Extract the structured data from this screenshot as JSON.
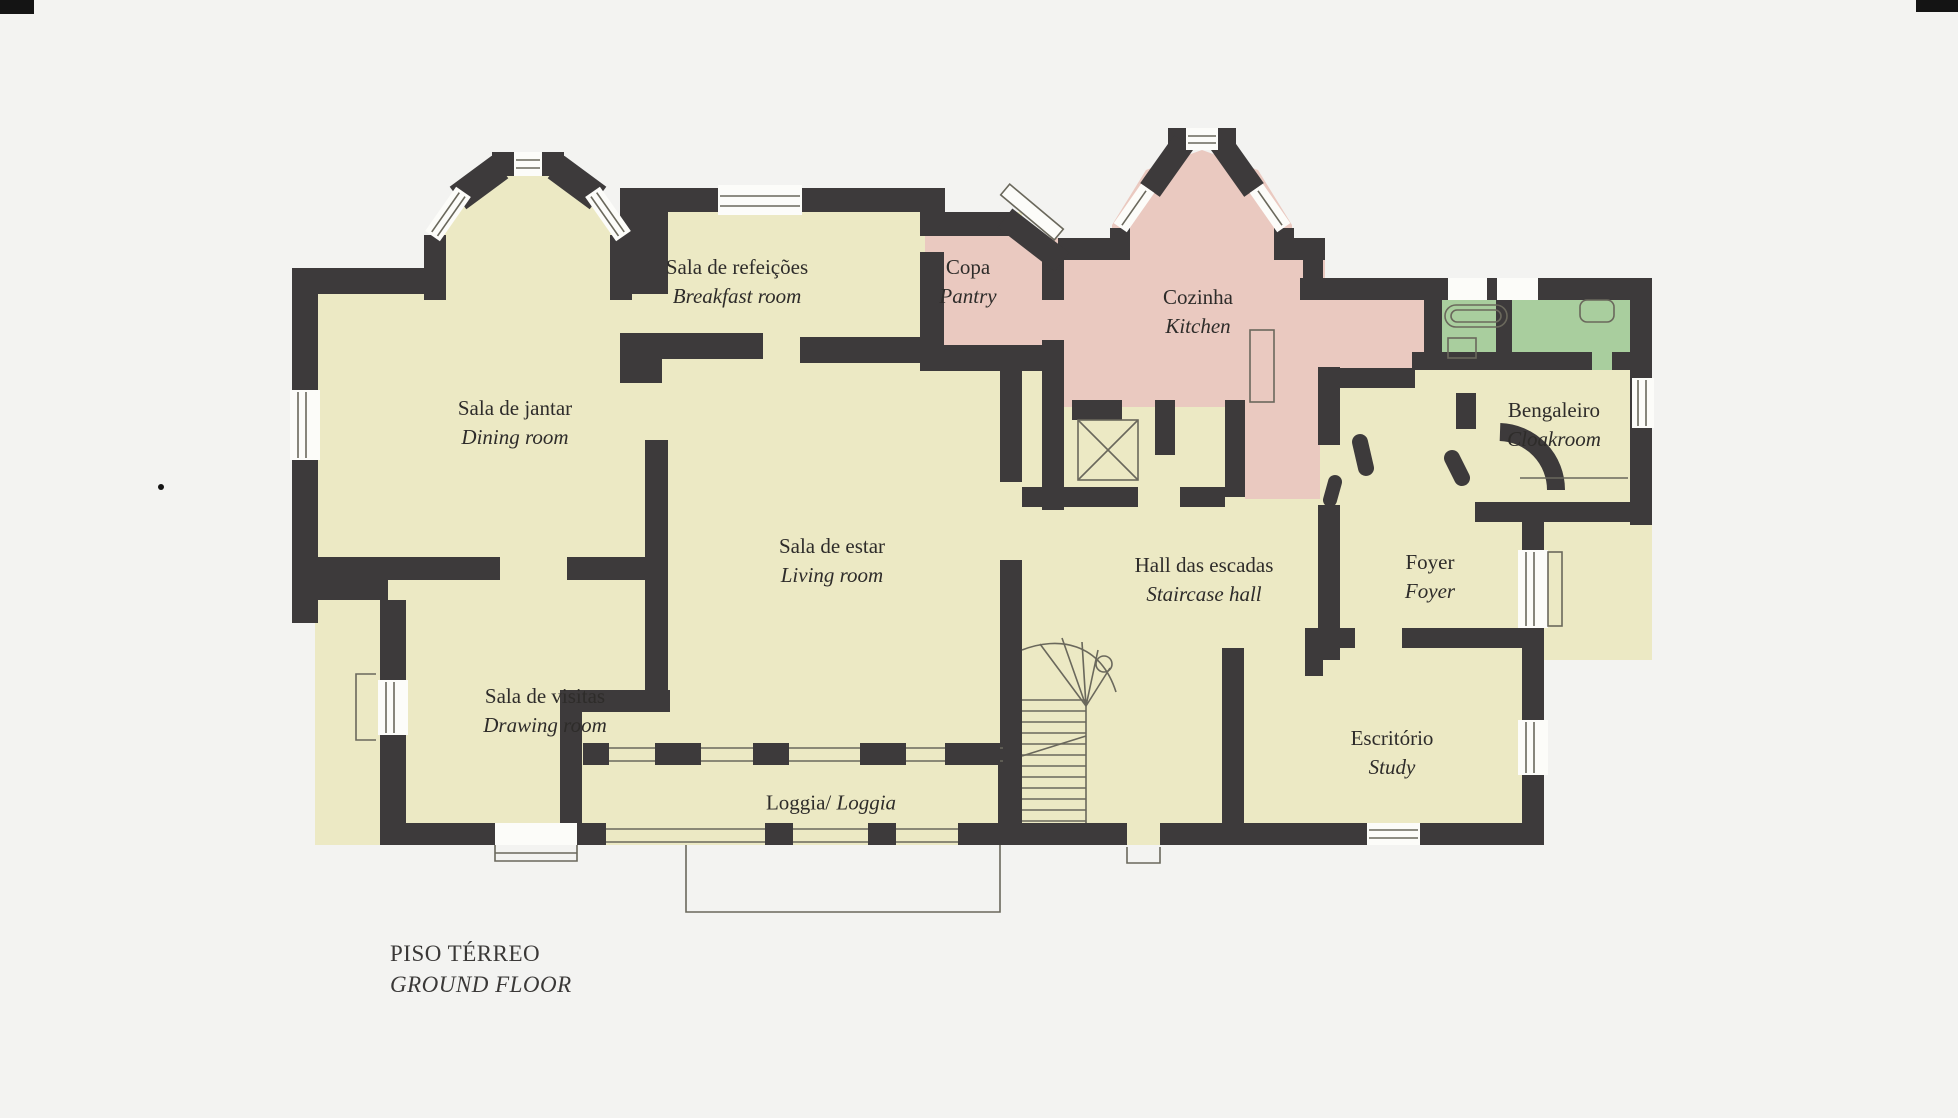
{
  "title": {
    "pt": "PISO TÉRREO",
    "en": "GROUND FLOOR"
  },
  "rooms": [
    {
      "id": "breakfast-room",
      "pt": "Sala de refeições",
      "en": "Breakfast room"
    },
    {
      "id": "pantry",
      "pt": "Copa",
      "en": "Pantry"
    },
    {
      "id": "kitchen",
      "pt": "Cozinha",
      "en": "Kitchen"
    },
    {
      "id": "dining-room",
      "pt": "Sala de jantar",
      "en": "Dining room"
    },
    {
      "id": "living-room",
      "pt": "Sala de estar",
      "en": "Living room"
    },
    {
      "id": "staircase-hall",
      "pt": "Hall das escadas",
      "en": "Staircase hall"
    },
    {
      "id": "foyer",
      "pt": "Foyer",
      "en": "Foyer"
    },
    {
      "id": "cloakroom",
      "pt": "Bengaleiro",
      "en": "Cloakroom"
    },
    {
      "id": "drawing-room",
      "pt": "Sala de visitas",
      "en": "Drawing room"
    },
    {
      "id": "study",
      "pt": "Escritório",
      "en": "Study"
    },
    {
      "id": "loggia",
      "pt": "Loggia/",
      "en": "Loggia"
    }
  ],
  "colors": {
    "paper": "#f3f3f1",
    "room": "#ece9c4",
    "service": "#eac9c0",
    "bath": "#a9ce9e",
    "wall": "#3d3a3b",
    "line": "#6a685c",
    "window": "#fcfcf9"
  }
}
